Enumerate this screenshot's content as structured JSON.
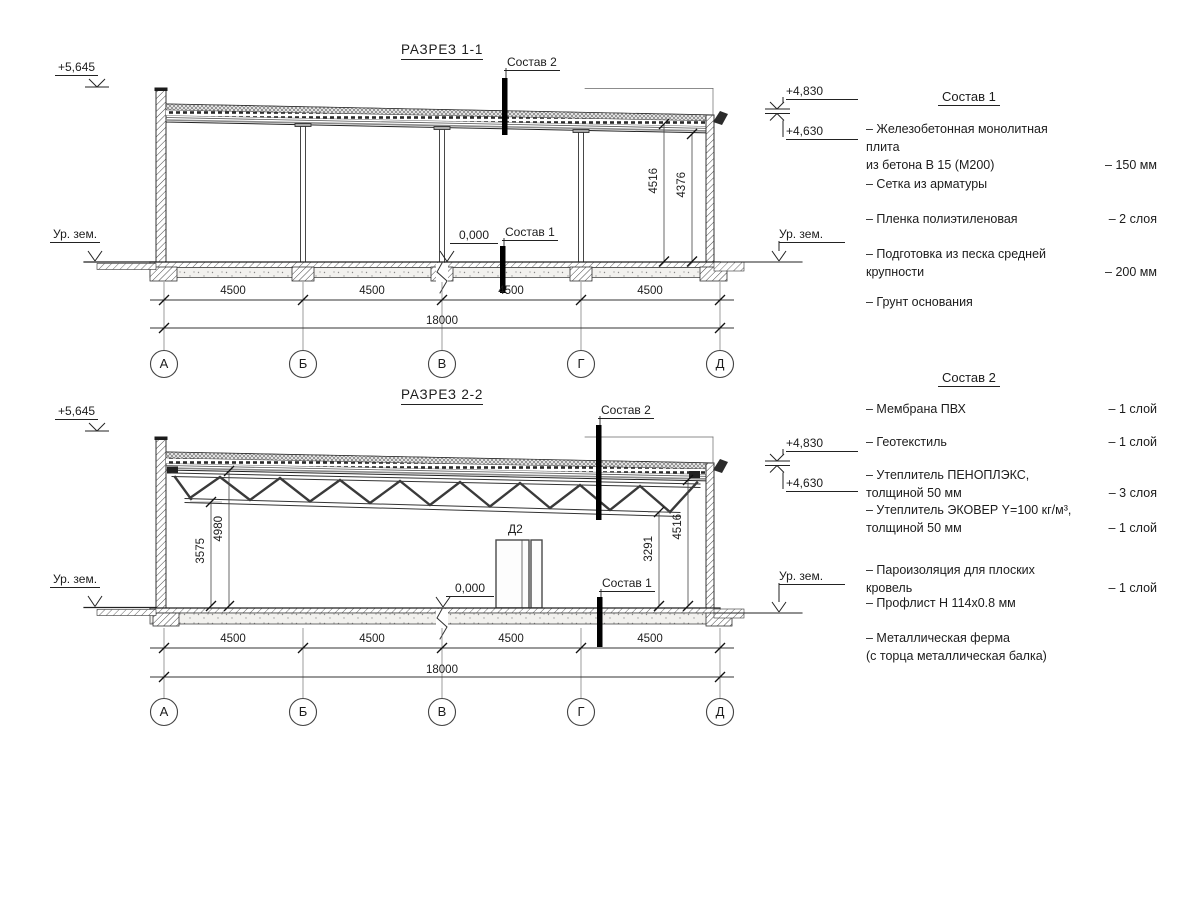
{
  "drawing": {
    "section1": {
      "title": "РАЗРЕЗ 1-1",
      "elev_parapet": "+5,645",
      "elev_roof_top": "+4,830",
      "elev_roof_low": "+4,630",
      "ground_label_left": "Ур. зем.",
      "ground_label_right": "Ур. зем.",
      "zero_level": "0,000",
      "marker_sostav2": "Состав 2",
      "marker_sostav1": "Состав 1",
      "dim_height_1": "4516",
      "dim_height_2": "4376",
      "span_dims": [
        "4500",
        "4500",
        "4500",
        "4500"
      ],
      "total_dim": "18000",
      "axes": [
        "А",
        "Б",
        "В",
        "Г",
        "Д"
      ]
    },
    "section2": {
      "title": "РАЗРЕЗ 2-2",
      "elev_parapet": "+5,645",
      "elev_roof_top": "+4,830",
      "elev_roof_low": "+4,630",
      "ground_label_left": "Ур. зем.",
      "ground_label_right": "Ур. зем.",
      "zero_level": "0,000",
      "marker_sostav2": "Состав 2",
      "marker_sostav1": "Состав 1",
      "door_label": "Д2",
      "dim_truss_clear": "3575",
      "dim_roof_clear": "4980",
      "dim_right_low": "3291",
      "dim_right_high": "4516",
      "span_dims": [
        "4500",
        "4500",
        "4500",
        "4500"
      ],
      "total_dim": "18000",
      "axes": [
        "А",
        "Б",
        "В",
        "Г",
        "Д"
      ]
    }
  },
  "legend1": {
    "title": "Состав 1",
    "items": [
      {
        "name": "– Железобетонная  монолитная плита\n  из бетона В 15 (М200)",
        "value": "– 150 мм"
      },
      {
        "name": "– Сетка из арматуры",
        "value": ""
      },
      {
        "name": "– Пленка полиэтиленовая",
        "value": "–  2 слоя"
      },
      {
        "name": "– Подготовка из песка средней\n  крупности",
        "value": "– 200 мм"
      },
      {
        "name": "– Грунт основания",
        "value": ""
      }
    ]
  },
  "legend2": {
    "title": "Состав 2",
    "items": [
      {
        "name": "– Мембрана ПВХ",
        "value": "– 1 слой"
      },
      {
        "name": "– Геотекстиль",
        "value": "– 1 слой"
      },
      {
        "name": "– Утеплитель ПЕНОПЛЭКС,\n  толщиной 50 мм",
        "value": "– 3 слоя"
      },
      {
        "name": "– Утеплитель ЭКОВЕР Y=100 кг/м³,\nтолщиной 50 мм",
        "value": "– 1 слой"
      },
      {
        "name": "– Пароизоляция для плоских кровель",
        "value": "– 1 слой"
      },
      {
        "name": "– Профлист Н 114х0.8 мм",
        "value": ""
      },
      {
        "name": "– Металлическая ферма\n  (с торца металлическая балка)",
        "value": ""
      }
    ]
  }
}
